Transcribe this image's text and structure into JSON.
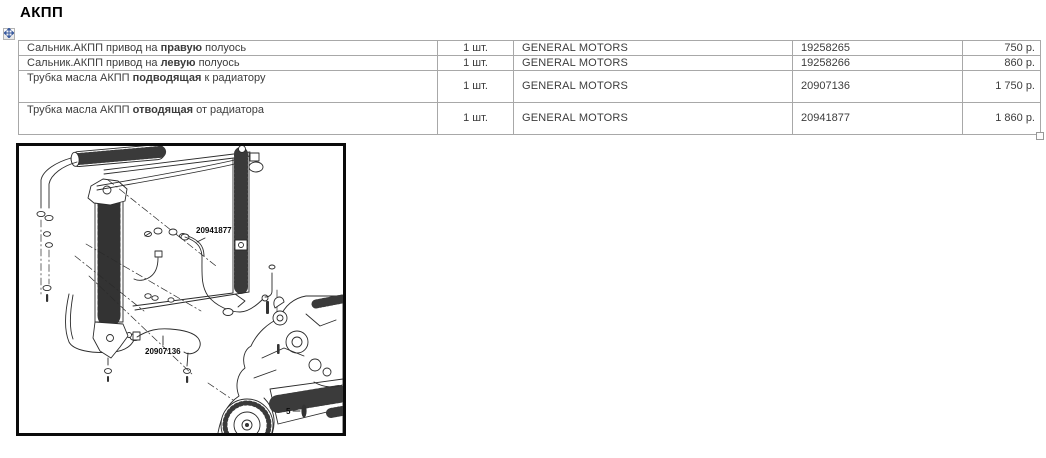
{
  "title": "АКПП",
  "table": {
    "rows": [
      {
        "name_prefix": "Сальник.АКПП привод на ",
        "name_bold": "правую",
        "name_suffix": " полуось",
        "qty": "1 шт.",
        "brand": "GENERAL MOTORS",
        "part_number": "19258265",
        "price": "750 р."
      },
      {
        "name_prefix": "Сальник.АКПП привод на ",
        "name_bold": "левую",
        "name_suffix": " полуось",
        "qty": "1 шт.",
        "brand": "GENERAL MOTORS",
        "part_number": "19258266",
        "price": "860 р."
      },
      {
        "name_prefix": "Трубка масла АКПП ",
        "name_bold": "подводящая",
        "name_suffix": " к радиатору",
        "qty": "1 шт.",
        "brand": "GENERAL MOTORS",
        "part_number": "20907136",
        "price": "1 750 р."
      },
      {
        "name_prefix": "Трубка масла АКПП ",
        "name_bold": "отводящая",
        "name_suffix": " от радиатора",
        "qty": "1 шт.",
        "brand": "GENERAL MOTORS",
        "part_number": "20941877",
        "price": "1 860 р."
      }
    ]
  },
  "diagram": {
    "labels": {
      "return_tube": "20941877",
      "supply_tube": "20907136",
      "bolt_callout": "5"
    }
  },
  "icons": {
    "move_handle": "four-direction-move-arrows",
    "resize_handle": "table-resize-square"
  },
  "colors": {
    "table_border": "#a8a8a8",
    "body_text": "#3c3c3c",
    "title_text": "#000000",
    "diagram_border": "#0a0a0a",
    "move_arrow": "#3a5b9f",
    "line_art": "#2b2b2b"
  }
}
